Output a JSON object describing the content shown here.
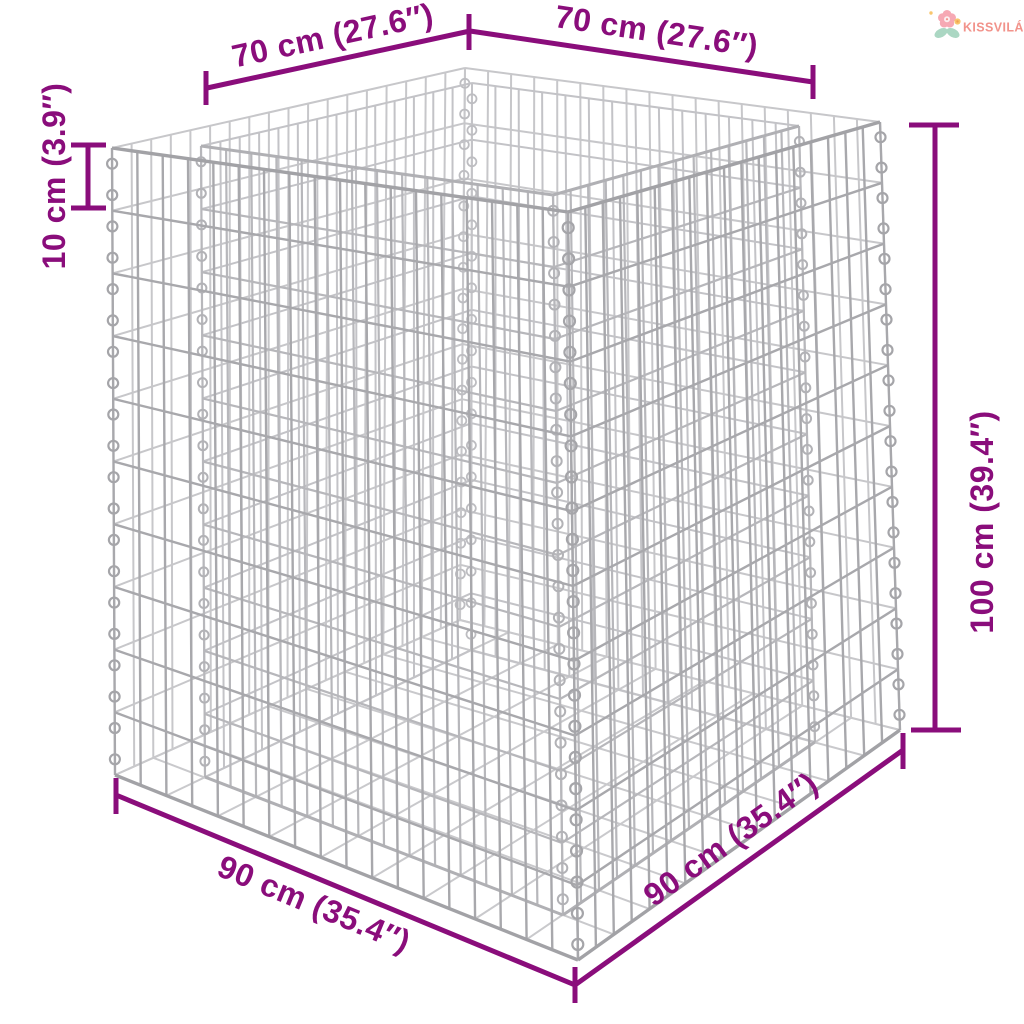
{
  "page": {
    "background": "#ffffff",
    "description": "Dimension diagram of a double-walled gabion wire-mesh raised planter basket"
  },
  "logo": {
    "brand": "KISSVILÁG",
    "text_color": "#f2938b",
    "petal_color": "#f6a9b4",
    "flower_center_color": "#fdeef0",
    "leaf_color": "#abd7c3",
    "accent_flower_color": "#f8c66d",
    "accent_flower_center_color": "#f0a24f"
  },
  "diagram": {
    "type": "product-dimension-diagram",
    "subject": "gabion raised bed wire mesh basket",
    "wire_color": "#aaaaae",
    "dimension_color": "#8a0d7b",
    "dimensions": {
      "top_left": {
        "label": "70 cm (27.6″)",
        "value_cm": 70,
        "value_in": 27.6
      },
      "top_right": {
        "label": "70 cm (27.6″)",
        "value_cm": 70,
        "value_in": 27.6
      },
      "left": {
        "label": "10 cm (3.9″)",
        "value_cm": 10,
        "value_in": 3.9
      },
      "right": {
        "label": "100 cm (39.4″)",
        "value_cm": 100,
        "value_in": 39.4
      },
      "bottom_left": {
        "label": "90 cm (35.4″)",
        "value_cm": 90,
        "value_in": 35.4
      },
      "bottom_right": {
        "label": "90 cm (35.4″)",
        "value_cm": 90,
        "value_in": 35.4
      }
    }
  }
}
